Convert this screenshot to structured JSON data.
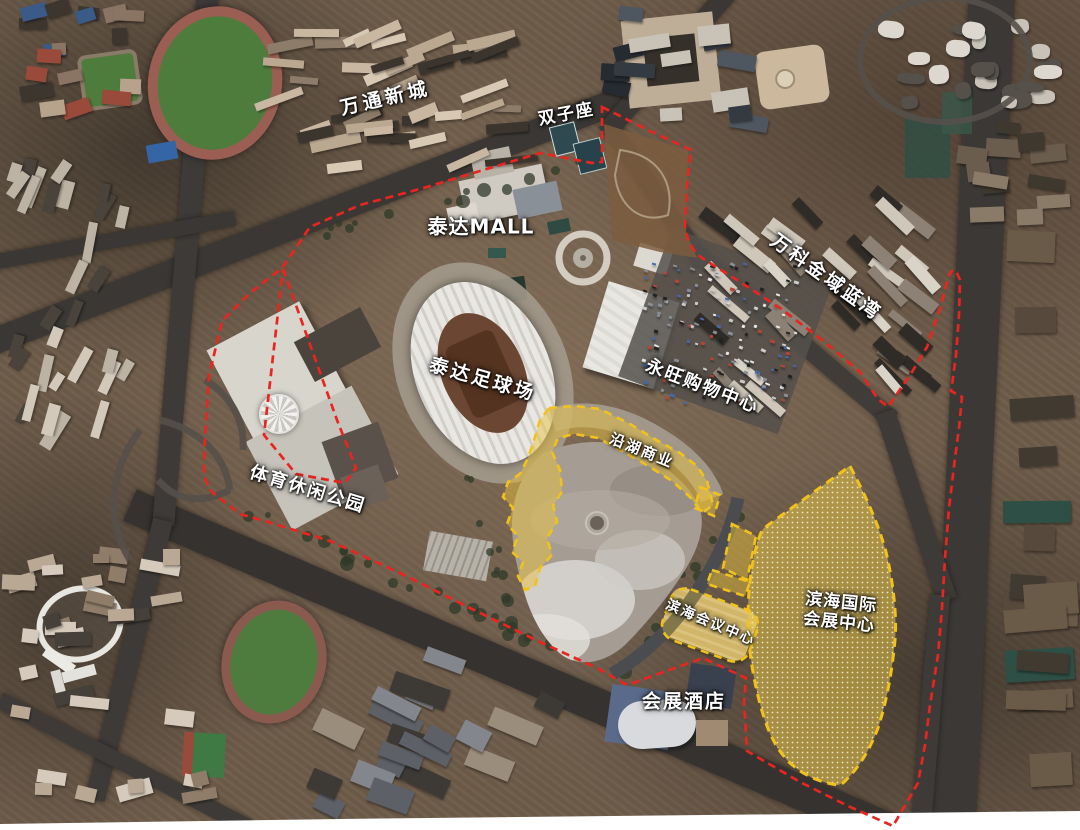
{
  "map": {
    "labels": [
      {
        "id": "wantong-new-town",
        "text": "万通新城"
      },
      {
        "id": "twin-towers",
        "text": "双子座"
      },
      {
        "id": "teda-mall",
        "text": "泰达MALL"
      },
      {
        "id": "vanke-jinyu-lanwan",
        "text": "万科金域蓝湾"
      },
      {
        "id": "teda-football-stadium",
        "text": "泰达足球场"
      },
      {
        "id": "aeon-shopping-center",
        "text": "永旺购物中心"
      },
      {
        "id": "lakeside-commerce",
        "text": "沿湖商业"
      },
      {
        "id": "sports-leisure-park",
        "text": "体育休闲公园"
      },
      {
        "id": "binhai-conference-center",
        "text": "滨海会议中心"
      },
      {
        "id": "binhai-intl-exhibition-center",
        "lines": [
          "滨海国际",
          "会展中心"
        ]
      },
      {
        "id": "exhibition-hotel",
        "text": "会展酒店"
      }
    ],
    "colors": {
      "boundary_red": "#e8251f",
      "highlight_yellow": "#f2c21c"
    }
  }
}
